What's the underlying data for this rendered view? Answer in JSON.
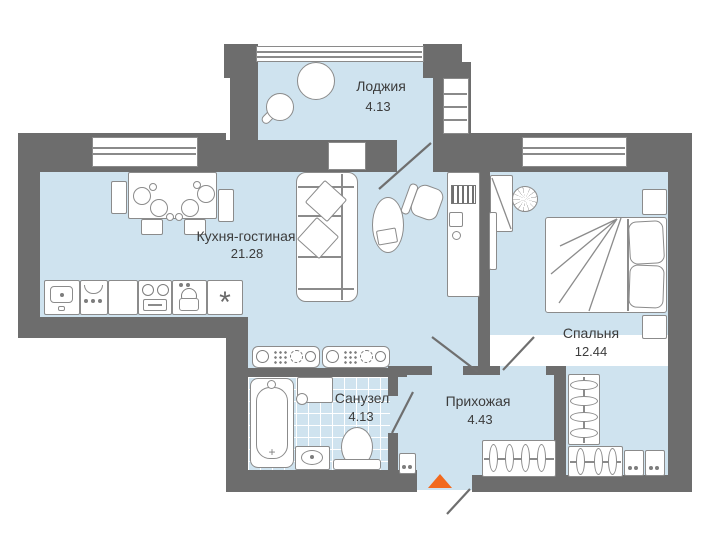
{
  "colors": {
    "wall": "#6d6d6d",
    "floor": "#cfe3ef",
    "accent": "#f2691d",
    "text": "#3c3c3c"
  },
  "rooms": [
    {
      "name": "Лоджия",
      "area": "4.13"
    },
    {
      "name": "Кухня-гостиная",
      "area": "21.28"
    },
    {
      "name": "Спальня",
      "area": "12.44"
    },
    {
      "name": "Санузел",
      "area": "4.13"
    },
    {
      "name": "Прихожая",
      "area": "4.43"
    }
  ],
  "entrance": {
    "marker": "triangle-up"
  },
  "icons": {
    "fridge": "snowflake",
    "dishwasher": "lock",
    "entrance": "orange-triangle"
  }
}
